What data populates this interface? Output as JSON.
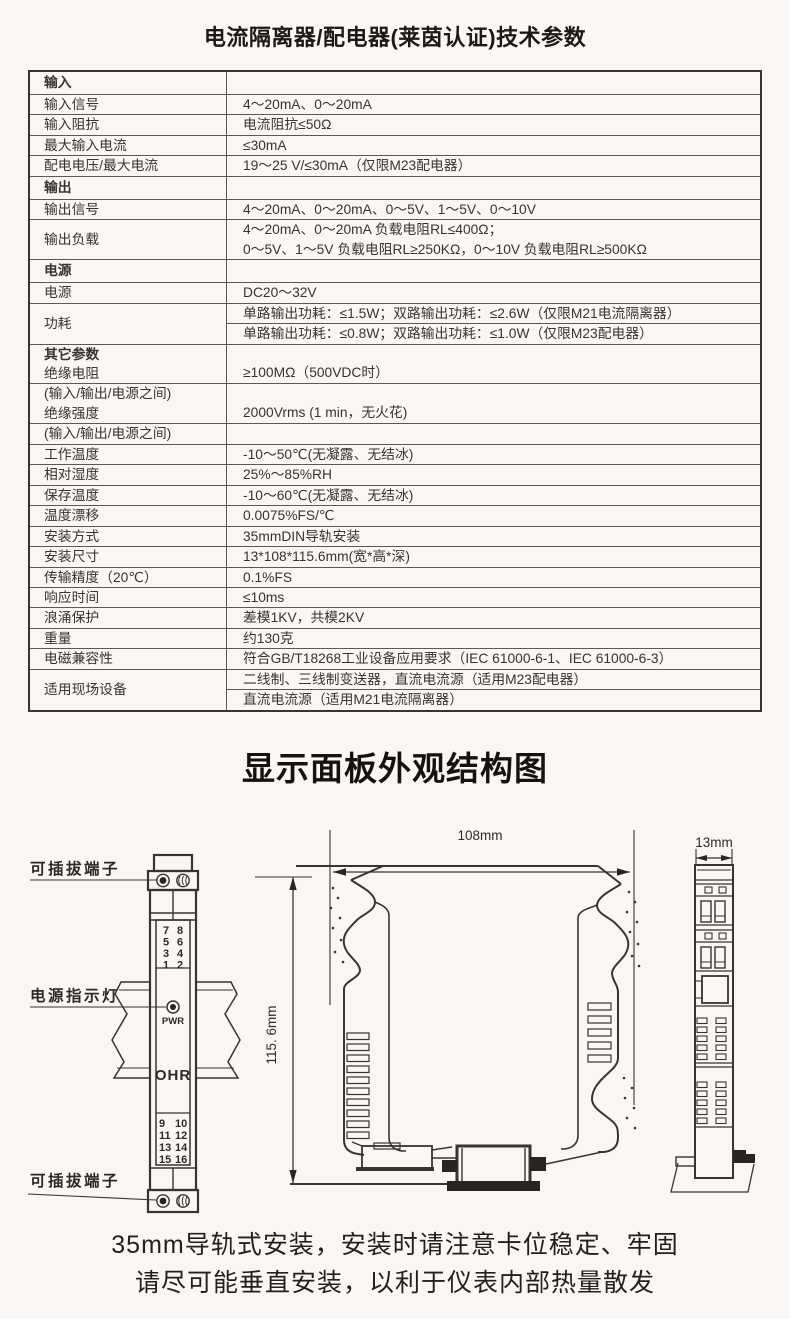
{
  "page": {
    "title": "电流隔离器/配电器(莱茵认证)技术参数"
  },
  "specs": {
    "rows": [
      {
        "label": "输入"
      },
      {
        "label": "输入信号",
        "value": "4～20mA、0～20mA"
      },
      {
        "label": "输入阻抗",
        "value": "电流阻抗≤50Ω"
      },
      {
        "label": "最大输入电流",
        "value": "≤30mA"
      },
      {
        "label": "配电电压/最大电流",
        "value": "19～25 V/≤30mA（仅限M23配电器）"
      },
      {
        "label": "输出"
      },
      {
        "label": "输出信号",
        "value": "4～20mA、0～20mA、0～5V、1～5V、0～10V"
      },
      {
        "label": "输出负载",
        "value": "4～20mA、0～20mA 负载电阻RL≤400Ω；",
        "value2": "0～5V、1～5V 负载电阻RL≥250KΩ，0～10V 负载电阻RL≥500KΩ"
      },
      {
        "label": "电源"
      },
      {
        "label": "电源",
        "value": "DC20～32V"
      },
      {
        "label": "功耗",
        "value": "单路输出功耗：≤1.5W；双路输出功耗：≤2.6W（仅限M21电流隔离器）",
        "value2": "单路输出功耗：≤0.8W；双路输出功耗：≤1.0W（仅限M23配电器）"
      },
      {
        "label": "其它参数",
        "label2": "绝缘电阻",
        "value": "≥100MΩ（500VDC时）"
      },
      {
        "label": "(输入/输出/电源之间)",
        "label2": "绝缘强度",
        "value": "2000Vrms (1 min，无火花)"
      },
      {
        "label": "(输入/输出/电源之间)",
        "value": ""
      },
      {
        "label": "工作温度",
        "value": "-10～50℃(无凝露、无结冰)"
      },
      {
        "label": "相对湿度",
        "value": "25%～85%RH"
      },
      {
        "label": "保存温度",
        "value": "-10～60℃(无凝露、无结冰)"
      },
      {
        "label": "温度漂移",
        "value": "0.0075%FS/℃"
      },
      {
        "label": "安装方式",
        "value": "35mmDIN导轨安装"
      },
      {
        "label": "安装尺寸",
        "value": "13*108*115.6mm(宽*高*深)"
      },
      {
        "label": "传输精度（20℃）",
        "value": "0.1%FS"
      },
      {
        "label": "响应时间",
        "value": "≤10ms"
      },
      {
        "label": "浪涌保护",
        "value": "差模1KV，共模2KV"
      },
      {
        "label": "重量",
        "value": "约130克"
      },
      {
        "label": "电磁兼容性",
        "value": "符合GB/T18268工业设备应用要求（IEC 61000-6-1、IEC 61000-6-3）"
      },
      {
        "label": "适用现场设备",
        "value": "二线制、三线制变送器，直流电流源（适用M23配电器）",
        "value2": "直流电流源（适用M21电流隔离器）"
      }
    ]
  },
  "diagram": {
    "title": "显示面板外观结构图",
    "labels": {
      "top_terminal": "可插拔端子",
      "power_led": "电源指示灯",
      "bottom_terminal": "可插拔端子"
    },
    "dims": {
      "width": "108mm",
      "height": "115. 6mm",
      "depth": "13mm"
    },
    "front": {
      "pwr": "PWR",
      "brand": "OHR",
      "tt": [
        [
          "7",
          "8"
        ],
        [
          "5",
          "6"
        ],
        [
          "3",
          "4"
        ],
        [
          "1",
          "2"
        ]
      ],
      "bt": [
        [
          "9",
          "10"
        ],
        [
          "11",
          "12"
        ],
        [
          "13",
          "14"
        ],
        [
          "15",
          "16"
        ]
      ]
    }
  },
  "footer": {
    "line1": "35mm导轨式安装，安装时请注意卡位稳定、牢固",
    "line2": "请尽可能垂直安装，以利于仪表内部热量散发"
  }
}
